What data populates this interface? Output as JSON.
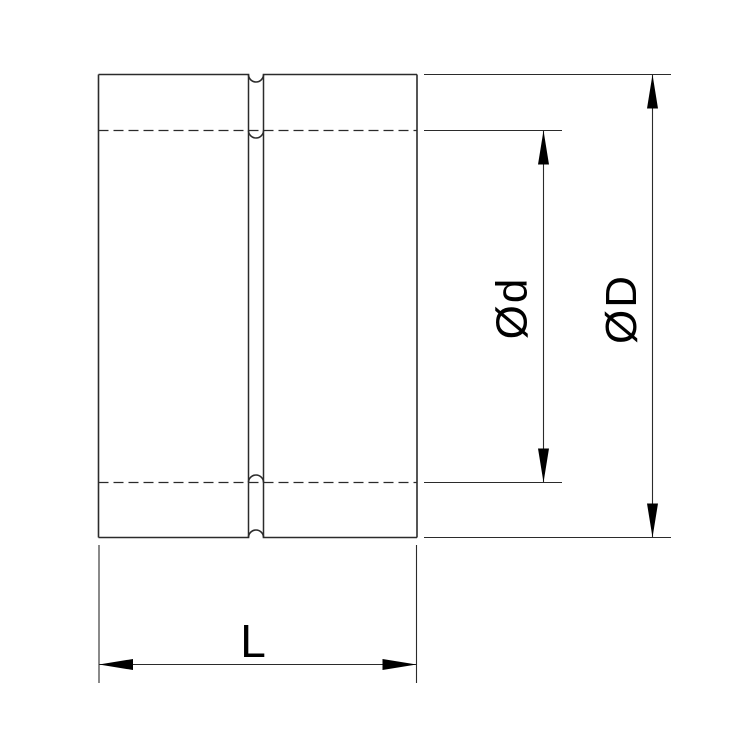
{
  "drawing": {
    "labels": {
      "inner_diameter": "Ød",
      "outer_diameter": "ØD",
      "length": "L"
    },
    "colors": {
      "line": "#2b2b2b",
      "text": "#000000",
      "background": "#ffffff"
    }
  }
}
